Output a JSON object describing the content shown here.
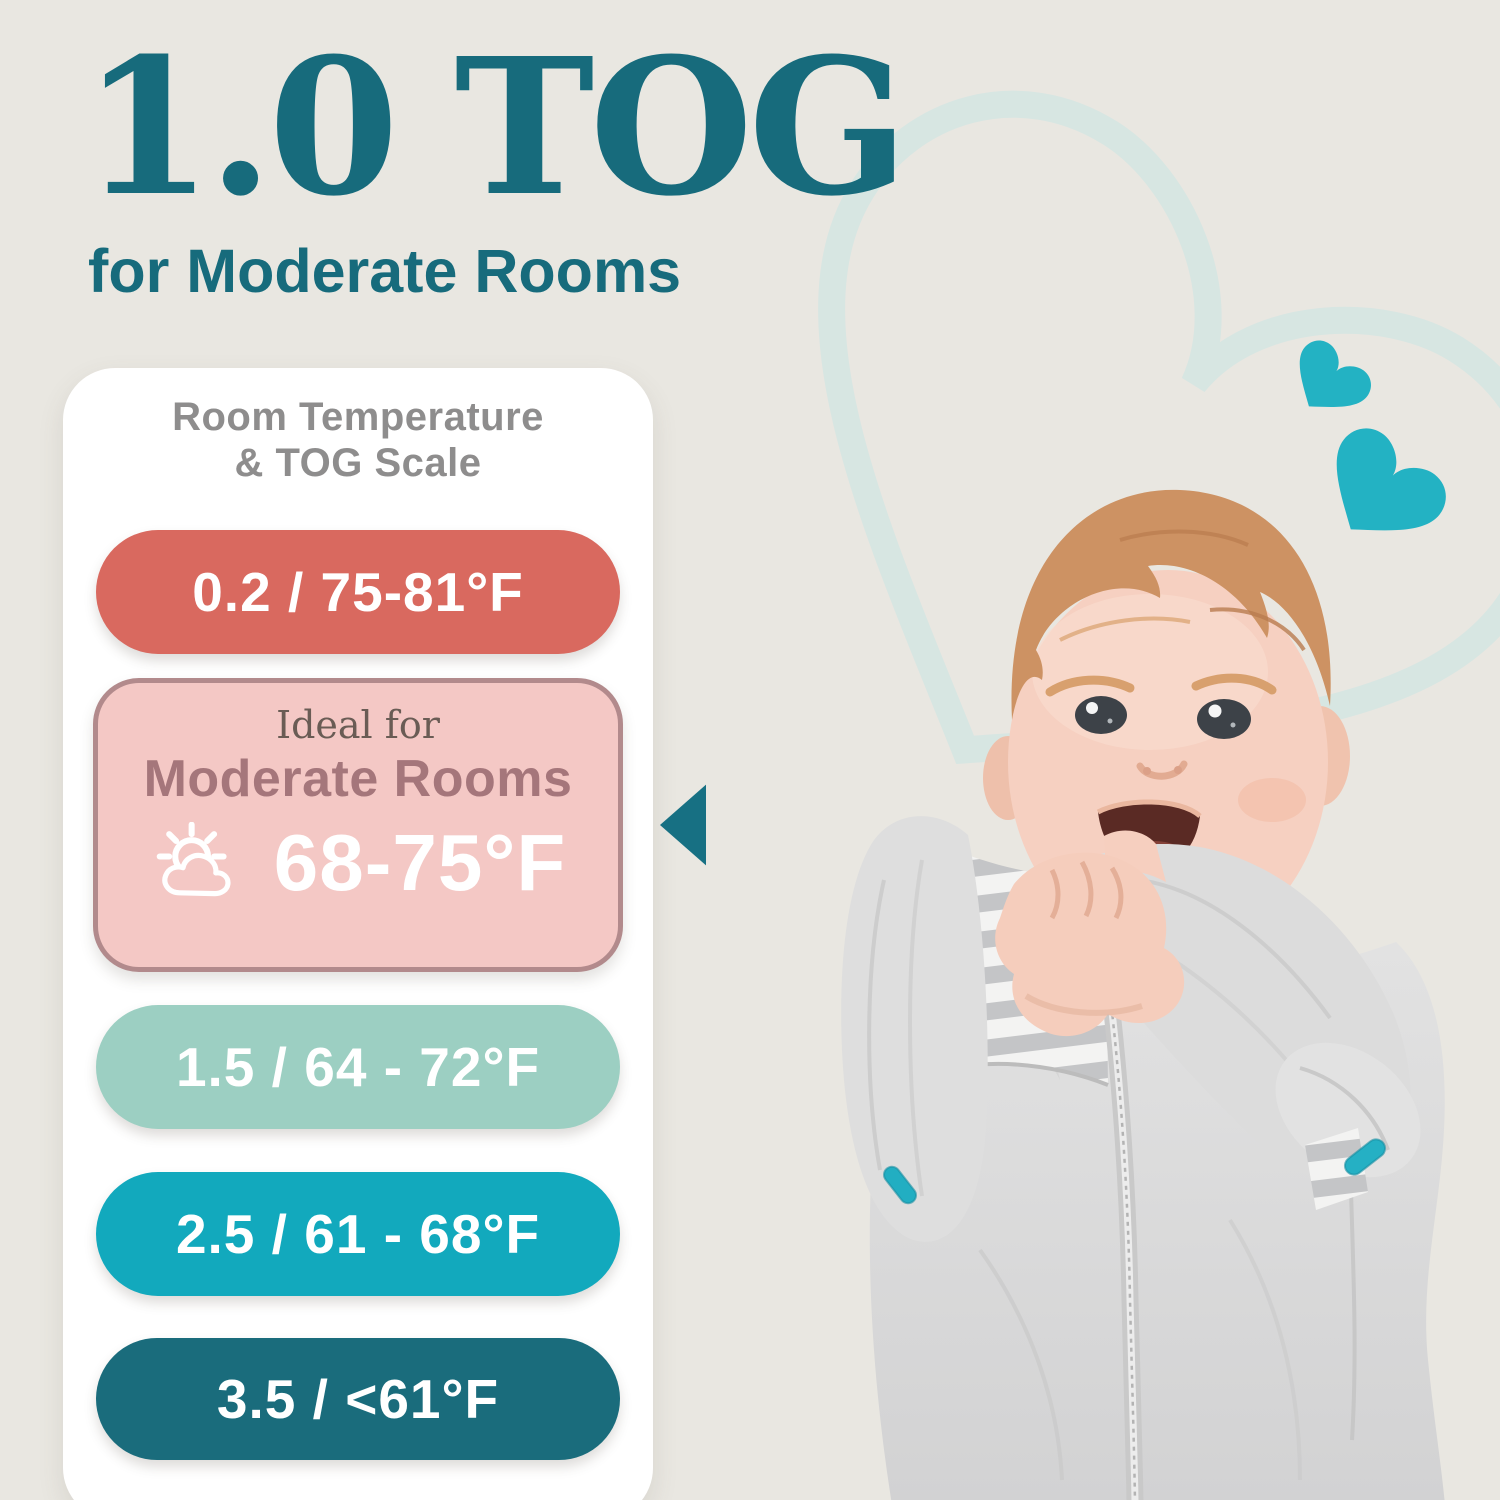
{
  "page": {
    "background": "#e9e7e1"
  },
  "header": {
    "tog_value": "1.0 TOG",
    "subtitle": "for Moderate Rooms",
    "text_color": "#176b7c"
  },
  "scale_card": {
    "background": "#ffffff",
    "heading_line1": "Room Temperature",
    "heading_line2": "& TOG Scale",
    "heading_color": "#8e8d8d",
    "pills": [
      {
        "label": "0.2 / 75-81°F",
        "bg": "#d9695f"
      },
      {
        "label": "1.5 / 64 - 72°F",
        "bg": "#9ccfc2"
      },
      {
        "label": "2.5 / 61 - 68°F",
        "bg": "#12a9bd"
      },
      {
        "label": "3.5 / <61°F",
        "bg": "#1a6c7c"
      }
    ],
    "ideal": {
      "eyebrow": "Ideal for",
      "room_type": "Moderate Rooms",
      "temperature": "68-75°F",
      "bg": "#f4c8c5",
      "border": "#b28a8c",
      "eyebrow_color": "#6a5c55",
      "room_type_color": "#a5767b"
    }
  },
  "pointer": {
    "color": "#177083"
  },
  "decor": {
    "heart_outline_color": "#d7e6e2",
    "heart_fill_color": "#23b2c3"
  },
  "icons": {
    "weather": "sun-behind-cloud-icon",
    "pointer": "left-triangle-icon",
    "hearts": "heart-icon"
  }
}
